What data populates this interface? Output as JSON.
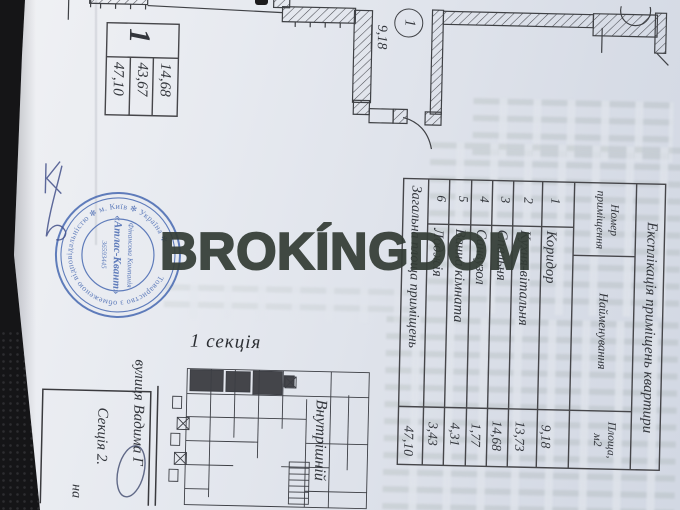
{
  "watermark": {
    "text": "BROKÍNGDOM",
    "color": "#343d36"
  },
  "apartment_stamp": {
    "apartment_number": "1",
    "areas_display_left_to_right": [
      "47,10",
      "43,67",
      "14,68"
    ]
  },
  "plan_label": {
    "room_number": "1",
    "room_area": "9,18"
  },
  "explication": {
    "title": "Експлікація приміщень квартири",
    "col_num_line1": "Номер",
    "col_num_line2": "приміщення",
    "col_name": "Найменування",
    "col_area_line1": "Площа,",
    "col_area_line2": "м2",
    "rows": [
      {
        "num": "1",
        "name": "Коридор",
        "area": "9,18"
      },
      {
        "num": "2",
        "name": "Кухня-вітальня",
        "area": "13,73"
      },
      {
        "num": "3",
        "name": "Спальня",
        "area": "14,68"
      },
      {
        "num": "4",
        "name": "Санвузол",
        "area": "1,77"
      },
      {
        "num": "5",
        "name": "Ванна кімната",
        "area": "4,31"
      },
      {
        "num": "6",
        "name": "Лоджія",
        "area": "3,43"
      }
    ],
    "total_label": "Загальна площа приміщень",
    "total_value": "47,10"
  },
  "labels": {
    "section1": "1 секція",
    "street": "вулиця Вадима Г",
    "inner": "Внутрішній",
    "titleblock_line1": "Секція 2.",
    "titleblock_line2": "на"
  },
  "stamp": {
    "ring_text": "Товариство з обмеженою відповідальністю ✻ м. Київ ✻ Україна ✻",
    "center_line1": "Фінансова Компанія",
    "center_line2": "«Атлас-Квант»",
    "center_line3": "36593445",
    "color": "#3c60ad"
  }
}
